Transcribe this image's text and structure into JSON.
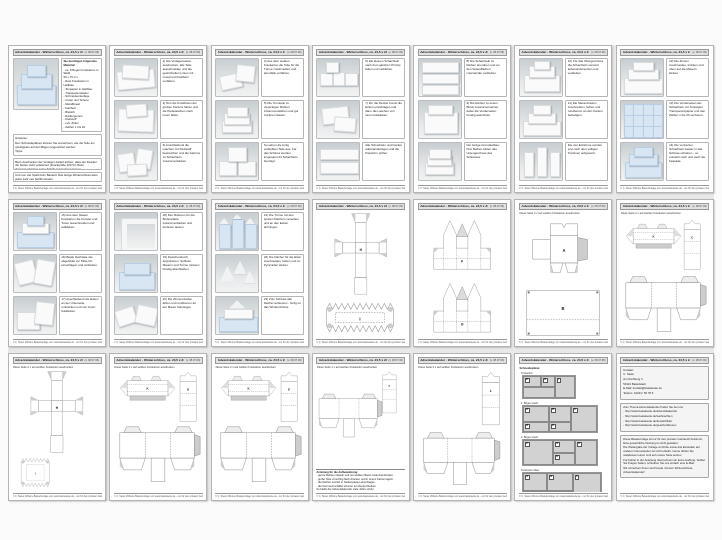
{
  "page_header": {
    "title": "Adventskalender - Winterschloss, ca. 24,5 x 24,5 x 24,5 cm",
    "right": "(v. 08.07.06)"
  },
  "page_footer": {
    "left": "© C. Steier 2006",
    "right": "eine Bastelvorlage von www.bastelseite.de - nur für den privaten Gebrauch"
  },
  "colors": {
    "page_bg": "#ffffff",
    "gutter": "#e8e8e8",
    "photo_bg": "#cdd3d6",
    "blue_paper": "#d8e6f4",
    "net_stroke": "#8a8a8a",
    "glue_tab": "#cdcdcd"
  },
  "pages": [
    {
      "type": "title",
      "photo": "castle-blue",
      "materials_title": "Sie benötigen folgendes Material:",
      "materials": [
        "- ca. 8 Bogen Fotokarton in Weiß,",
        "  50 x 70 cm",
        "- Rest Fotokarton in Hellblau",
        "- Tonpapier in Hellblau",
        "- Transparentpapier",
        "- Schneideunterlage",
        "- Cutter und Schere",
        "- Metalllineal",
        "- Falzbein",
        "- Bleistift",
        "- Radiergummi",
        "- Klebstoff",
        "- evtl. Zirkel",
        "- Zahlen 1 bis 24"
      ],
      "sections": [
        {
          "lines": [
            "Hinweise:",
            "Den Schneideplänen können Sie entnehmen, wie die Teile am günstigsten auf den Bögen angeordnet werden.",
            "Tipps:",
            "Bevor Sie beginnen, die komplette Anleitung einmal durchlesen. Zuerst alle Teile zuschneiden und die gestrichelten Linien mit dem Falzbein vorfalzen."
          ]
        },
        {
          "lines": [
            "Beim Ausdrucken der Vorlagen darauf achten, dass der Drucker die Seiten nicht verkleinert (Druckgröße 100 %). Beim Zusammenkleben jeden Schritt gut trocknen lassen."
          ]
        },
        {
          "lines": [
            "Und nun viel Spaß beim Basteln! Das fertige Winterschloss kann jedes Jahr neu befüllt werden."
          ]
        }
      ]
    },
    {
      "type": "steps",
      "steps": [
        {
          "photo": "flat",
          "text": "1) Die Vorlagenseiten ausdrucken, alle Teile ausschneiden und die gestrichelten Linien mit Lineal und Falzbein vorfalzen."
        },
        {
          "photo": "flat2",
          "text": "2) Nun die Knicklinien der großen Kartons falzen und die Klebelaschen nach innen falten."
        },
        {
          "photo": "pieces",
          "text": "3) Anschließend die Laschen mit Klebstoff bestreichen und die Kartons zu Schachteln zusammenkleben."
        }
      ]
    },
    {
      "type": "steps",
      "steps": [
        {
          "photo": "pieces2",
          "text": "4) Aus dem weißen Fotokarton die Teile für die Türme zuschneiden und ebenfalls vorfalzen."
        },
        {
          "photo": "stack",
          "text": "5) Die Turmteile zu viereckigen Röhren zusammenkleben und gut trocknen lassen."
        },
        {
          "photo": "stack2",
          "text": "So sehen die fertig verklebten Teile aus. Für das Schloss werden insgesamt 24 Schachteln benötigt."
        }
      ]
    },
    {
      "type": "steps",
      "steps": [
        {
          "photo": "boxes",
          "text": "6) Die kleinen Schachteln nach dem gleichen Prinzip falten und verkleben."
        },
        {
          "photo": "lids",
          "text": "7) Für die Deckel zuerst die Ecken einschlagen und dann die Laschen von innen festkleben."
        },
        {
          "photo": "rows",
          "text": "Alle Schachteln und Deckel aufeinanderlegen und die Passform prüfen."
        }
      ]
    },
    {
      "type": "steps",
      "steps": [
        {
          "photo": "rows2",
          "text": "8) Die Schachteln zu Reihen anordnen und an den Seitenflächen miteinander verkleben."
        },
        {
          "photo": "block",
          "text": "9) Die Reihen zu einem Block zusammensetzen, dabei die Vorderseiten bündig ausrichten."
        },
        {
          "photo": "stack",
          "text": "Der fertige Grundaufbau: Drei Reihen bilden das Untergeschoss des Schlosses."
        }
      ]
    },
    {
      "type": "steps",
      "steps": [
        {
          "photo": "block2",
          "text": "10) Für das Obergeschoss die Schachteln versetzt aufeinandersetzen und verkleben."
        },
        {
          "photo": "castle-white",
          "text": "11) Die Mauerstreifen zuschneiden, falzen und rundherum an den Kanten befestigen."
        },
        {
          "photo": "towers",
          "text": "Die vier Ecktürme werden erst nach dem völligen Trocknen aufgesetzt."
        }
      ]
    },
    {
      "type": "steps",
      "steps": [
        {
          "photo": "castle-white2",
          "text": "12) Die Zinnen zuschneiden, knicken und oben auf die Mauern kleben."
        },
        {
          "photo": "blue-grid",
          "text": "13) Die Vorderseiten der Schachteln mit Tonpapier, Transparentpapier und den Zahlen 1 bis 24 verzieren."
        },
        {
          "photo": "castle-blue",
          "text": "14) Die verzierten Schachteln wieder in das Schloss schieben - so entsteht nach und nach die Fassade."
        }
      ]
    },
    {
      "type": "steps",
      "steps": [
        {
          "photo": "castle-blue2",
          "text": "15) Aus dem blauen Fotokarton die Fenster und Türen ausschneiden und aufkleben."
        },
        {
          "photo": "curved",
          "text": "16) Beide Dachteile wie abgebildet zur Mitte hin einschlagen und verkleben."
        },
        {
          "photo": "corner",
          "text": "17) Anschließend die Ecken an der Unterseite umknicken und von innen festkleben."
        }
      ]
    },
    {
      "type": "steps",
      "steps": [
        {
          "photo": "frame",
          "text": "18) Den Rahmen für die Bodenplatte zusammenkleben und trocknen lassen."
        },
        {
          "photo": "castle-blue3",
          "text": "19) Zwischendurch anprobieren: Schloss, Mauern und Türme müssen bündig abschließen."
        },
        {
          "photo": "battlements",
          "text": "20) Die Zinnenstreifen falzen und rundherum an der Mauer befestigen."
        }
      ]
    },
    {
      "type": "steps",
      "steps": [
        {
          "photo": "towers-blue",
          "text": "21) Die Türme mit den spitzen Dächern versehen und an den Ecken anbringen."
        },
        {
          "photo": "roofs",
          "text": "22) Die Dächer für die Erker zuschneiden, falzen und zu Pyramiden kleben."
        },
        {
          "photo": "castle-roofs",
          "text": "23) Zum Schluss alle Dächer aufsetzen - fertig ist das Winterschloss."
        }
      ]
    },
    {
      "type": "nets",
      "subtitle": "",
      "nets": [
        {
          "kind": "cross",
          "letter": "H"
        },
        {
          "kind": "zigrect",
          "letter": "I"
        }
      ]
    },
    {
      "type": "nets",
      "subtitle": "",
      "nets": [
        {
          "kind": "gable",
          "letter": "F"
        },
        {
          "kind": "gable",
          "letter": "G"
        }
      ]
    },
    {
      "type": "nets",
      "subtitle": "Diese Seite 4 x auf weißen Fotokarton ausdrucken",
      "nets": [
        {
          "kind": "boxflap",
          "letter": "A"
        },
        {
          "kind": "bigsquare",
          "letter": "B"
        }
      ]
    },
    {
      "type": "nets",
      "subtitle": "Diese Seite 2 x auf weißen Fotokarton ausdrucken",
      "nets": [
        {
          "kind": "roofstrip",
          "letter": "K"
        },
        {
          "kind": "tallbox",
          "letter": "C"
        },
        {
          "kind": "widebox",
          "letter": ""
        }
      ]
    },
    {
      "type": "nets",
      "subtitle": "Diese Seite 2 x auf weißen Fotokarton ausdrucken",
      "nets": [
        {
          "kind": "cross",
          "letter": "H"
        },
        {
          "kind": "zigsquare",
          "letter": "I"
        }
      ]
    },
    {
      "type": "nets",
      "subtitle": "Diese Seite 2 x auf weißen Fotokarton ausdrucken",
      "nets": [
        {
          "kind": "roofstrip",
          "letter": "K"
        },
        {
          "kind": "tallbox",
          "letter": "D"
        },
        {
          "kind": "widebox",
          "letter": ""
        }
      ]
    },
    {
      "type": "nets",
      "subtitle": "Diese Seite 2 x auf weißen Fotokarton ausdrucken",
      "nets": [
        {
          "kind": "roofstrip",
          "letter": "K"
        },
        {
          "kind": "tallbox",
          "letter": "E"
        },
        {
          "kind": "widebox",
          "letter": ""
        }
      ]
    },
    {
      "type": "nets",
      "subtitle": "Diese Seite 1 x auf weißen Fotokarton ausdrucken",
      "nets": [
        {
          "kind": "tallbox",
          "letter": "F"
        },
        {
          "kind": "widebox",
          "letter": ""
        }
      ],
      "note": {
        "heading": "Anleitung für die Aufbewahrung:",
        "lines": [
          "- ganze Reihen stapeln und mit weißem Band zusammenbinden,",
          "- große Teile vorsichtig flach drücken und in einem Karton lagern,",
          "- die Dächer einzeln in Seidenpapier einschlagen,",
          "- die Nummernschilder können am Deckel bleiben.",
          "So bleibt der Adventskalender viele Jahre schön."
        ]
      }
    },
    {
      "type": "nets",
      "subtitle": "Diese Seite 2 x auf weißen Fotokarton ausdrucken",
      "nets": [
        {
          "kind": "tallbox",
          "letter": "L"
        },
        {
          "kind": "widebox",
          "letter": ""
        }
      ]
    },
    {
      "type": "layout",
      "intro": "Schneidepläne:",
      "groups": [
        {
          "label": "Tonkarton:",
          "w": 52,
          "h": 22,
          "cells": [
            {
              "x": 0,
              "y": 0,
              "w": 18,
              "h": 11,
              "l": "E"
            },
            {
              "x": 18,
              "y": 0,
              "w": 14,
              "h": 11,
              "l": "H"
            },
            {
              "x": 0,
              "y": 11,
              "w": 32,
              "h": 11,
              "l": ""
            },
            {
              "x": 32,
              "y": 0,
              "w": 20,
              "h": 22,
              "l": "I"
            }
          ]
        },
        {
          "label": "1. Bogen weiß:",
          "w": 74,
          "h": 26,
          "cells": [
            {
              "x": 0,
              "y": 0,
              "w": 26,
              "h": 16,
              "l": "A"
            },
            {
              "x": 26,
              "y": 0,
              "w": 22,
              "h": 16,
              "l": "B"
            },
            {
              "x": 48,
              "y": 0,
              "w": 26,
              "h": 26,
              "l": "C"
            },
            {
              "x": 0,
              "y": 16,
              "w": 26,
              "h": 10,
              "l": "D"
            },
            {
              "x": 26,
              "y": 16,
              "w": 22,
              "h": 10,
              "l": "E"
            }
          ]
        },
        {
          "label": "2. Bogen weiß:",
          "w": 74,
          "h": 25,
          "cells": [
            {
              "x": 0,
              "y": 0,
              "w": 30,
              "h": 25,
              "l": "C"
            },
            {
              "x": 30,
              "y": 0,
              "w": 22,
              "h": 13,
              "l": "G"
            },
            {
              "x": 52,
              "y": 0,
              "w": 22,
              "h": 25,
              "l": "K"
            },
            {
              "x": 30,
              "y": 13,
              "w": 22,
              "h": 12,
              "l": "D"
            }
          ]
        },
        {
          "label": "Fotokarton blau:",
          "w": 78,
          "h": 30,
          "cells": [
            {
              "x": 0,
              "y": 0,
              "w": 24,
              "h": 18,
              "l": "A"
            },
            {
              "x": 24,
              "y": 0,
              "w": 26,
              "h": 18,
              "l": "B"
            },
            {
              "x": 50,
              "y": 0,
              "w": 28,
              "h": 30,
              "l": "F"
            },
            {
              "x": 0,
              "y": 18,
              "w": 24,
              "h": 12,
              "l": "L"
            },
            {
              "x": 24,
              "y": 18,
              "w": 26,
              "h": 12,
              "l": "D"
            }
          ]
        }
      ]
    },
    {
      "type": "contact",
      "boxes": [
        {
          "lines": [
            "Kontakt:",
            "C. Steier",
            "Am Kirchberg 3",
            "54321 Bastelstadt",
            "E-Mail: kontakt@bastelseite.de",
            "Telefon: 01234 / 56 78 9"
          ]
        },
        {
          "lines": [
            "Zum Thema Adventskalender finden Sie bei uns:",
            "- http://www.bastelseite.de/adventskalender",
            "- http://www.bastelseite.de/weihnachten",
            "- http://www.bastelseite.de/fensterbilder",
            "- http://www.bastelseite.de/geschenkboxen"
          ]
        },
        {
          "lines": [
            "Diese Bastelvorlage ist nur für den privaten Gebrauch bestimmt. Eine gewerbliche Nutzung ist nicht gestattet.",
            "Die Weitergabe der Vorlage an Dritte sowie das Einstellen auf anderen Internetseiten ist nicht erlaubt. Gerne dürfen Sie stattdessen einen Link auf unsere Seite setzen.",
            "Für Fehler in der Anleitung übernehmen wir keine Haftung. Sollten Sie Fragen haben, schreiben Sie uns einfach eine E-Mail.",
            "Wir wünschen Ihnen viel Freude mit dem Winterschloss-Adventskalender!"
          ]
        }
      ]
    }
  ]
}
